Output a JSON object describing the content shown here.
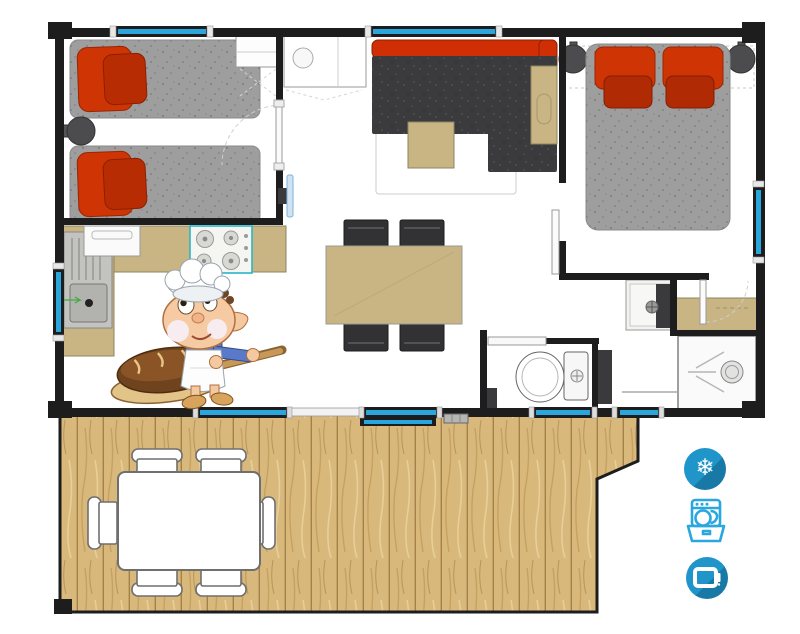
{
  "plan": {
    "rooms": [
      "twin-bedroom",
      "kitchen",
      "living-room",
      "dining-area",
      "master-bedroom",
      "bathroom",
      "wc",
      "terrace"
    ],
    "furniture": {
      "twin_bedroom": [
        "single-bed",
        "single-bed",
        "nightstand",
        "wardrobe"
      ],
      "kitchen": [
        "sink-unit",
        "fridge",
        "gas-hob",
        "counter",
        "wall-cabinet-with-sink"
      ],
      "living_room": [
        "corner-sofa",
        "coffee-table",
        "side-table",
        "rug",
        "wall-tv"
      ],
      "dining_area": [
        "dining-table",
        "chair",
        "chair",
        "chair",
        "chair"
      ],
      "master_bedroom": [
        "double-bed",
        "nightstand",
        "nightstand"
      ],
      "bathroom": [
        "washbasin",
        "counter",
        "shower"
      ],
      "wc": [
        "toilet",
        "shelf"
      ],
      "terrace": [
        "wood-deck",
        "garden-table",
        "chair",
        "chair",
        "chair",
        "chair",
        "chair",
        "chair"
      ]
    },
    "openings": [
      "top-window",
      "top-window",
      "left-window",
      "right-window",
      "sliding-bay-door",
      "sliding-bay-door",
      "bottom-window",
      "bottom-window"
    ]
  },
  "amenities": [
    {
      "id": "air-conditioning",
      "icon": "snowflake-icon",
      "glyph": "❄"
    },
    {
      "id": "dishwasher",
      "icon": "dishwasher-icon"
    },
    {
      "id": "television",
      "icon": "tv-icon"
    }
  ],
  "mascot": {
    "id": "baker-elf",
    "holding": "bread-loaf-on-peel"
  },
  "colors": {
    "wall": "#1d1d1d",
    "window_glass": "#2aa6dd",
    "bed_gray": "#9e9e9e",
    "pillow_orange_red": "#cf3404",
    "pillow_dark_red": "#b02a03",
    "sofa_charcoal": "#3b3b3d",
    "sofa_back_red": "#d02f05",
    "furniture_tan": "#c9b484",
    "deck_wood": "#d9b87c",
    "hob_accent_teal": "#2ab6c9",
    "icon_blue": "#2095ca",
    "icon_blue_shadow": "#1878a6",
    "icon_outline_blue": "#2aa7de"
  }
}
